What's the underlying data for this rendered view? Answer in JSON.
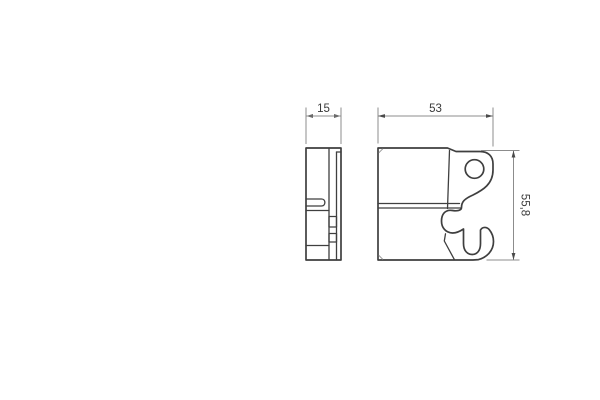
{
  "drawing": {
    "colors": {
      "background": "#ffffff",
      "outline": "#3f3f3f",
      "dimension_lines": "#8c8c8c",
      "text": "#3a3a3a"
    },
    "dimensions": {
      "side_view_width": "15",
      "front_view_width": "53",
      "front_view_height": "55,8"
    }
  }
}
